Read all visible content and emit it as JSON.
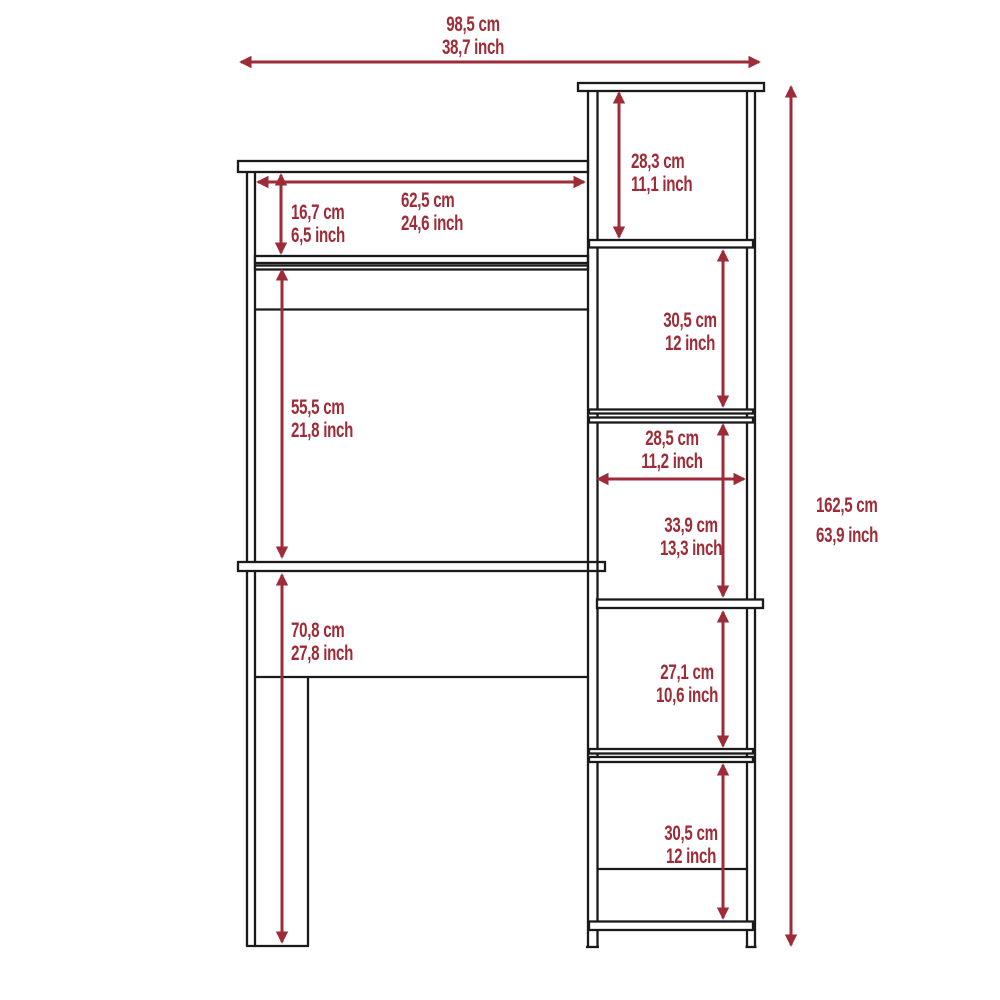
{
  "diagram": {
    "kind": "furniture-dimension-diagram",
    "subject": "desk with side bookcase tower",
    "accent_color": "#9e2c38",
    "line_color": "#1a1a1a",
    "background_color": "#ffffff",
    "dimensions": {
      "overall_width": {
        "cm": "98,5 cm",
        "inch": "38,7 inch"
      },
      "overall_height": {
        "cm": "162,5 cm",
        "inch": "63,9 inch"
      },
      "hutch_inner_width": {
        "cm": "62,5 cm",
        "inch": "24,6 inch"
      },
      "hutch_opening_height": {
        "cm": "16,7 cm",
        "inch": "6,5 inch"
      },
      "hutch_to_desktop_height": {
        "cm": "55,5 cm",
        "inch": "21,8 inch"
      },
      "desktop_to_floor_height": {
        "cm": "70,8 cm",
        "inch": "27,8 inch"
      },
      "tower_cubby_1_height": {
        "cm": "28,3 cm",
        "inch": "11,1 inch"
      },
      "tower_cubby_2_height": {
        "cm": "30,5 cm",
        "inch": "12 inch"
      },
      "tower_inner_width": {
        "cm": "28,5 cm",
        "inch": "11,2 inch"
      },
      "tower_cubby_3_height": {
        "cm": "33,9 cm",
        "inch": "13,3 inch"
      },
      "tower_cubby_4_height": {
        "cm": "27,1 cm",
        "inch": "10,6 inch"
      },
      "tower_cubby_5_height": {
        "cm": "30,5 cm",
        "inch": "12 inch"
      }
    }
  }
}
